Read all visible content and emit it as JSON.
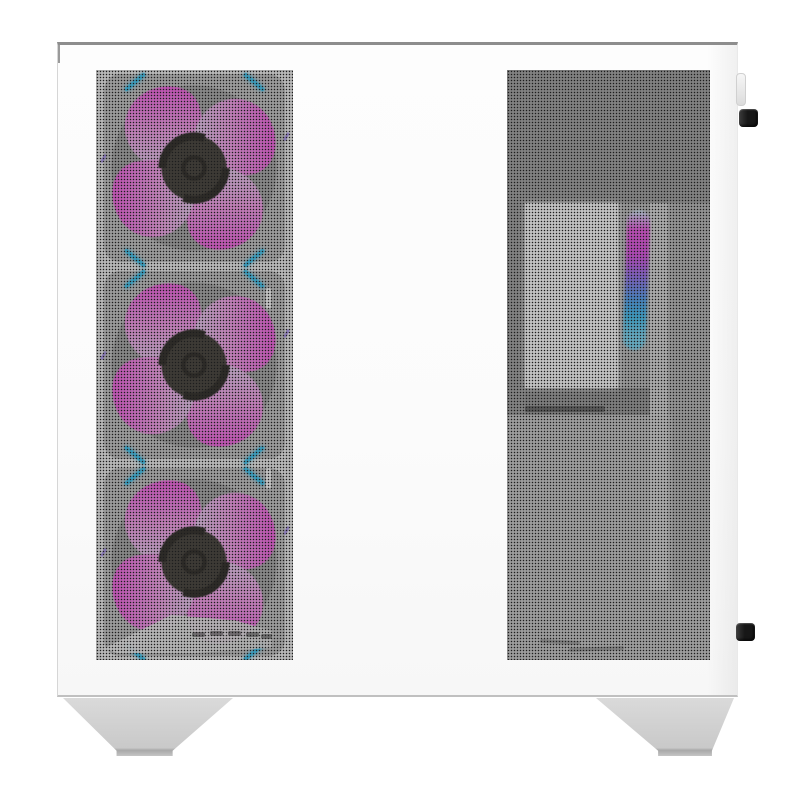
{
  "scene": {
    "subject": "White mid-tower PC case, side view product photo",
    "details": "Front mesh strip with three ARGB fans glowing magenta-to-cyan, perforated side panel showing white interior plate and vertical RGB glow, two black rear thumbscrews, two grey trapezoid feet",
    "background_color": "#ffffff"
  },
  "colors": {
    "bg": "#ffffff",
    "case-body": "#fbfbfb",
    "case-top-edge": "#8d8d8d",
    "case-side-edge": "#d6d6d6",
    "case-bottom-edge": "#c0c0c0",
    "mesh-dot": "#1d1d1d",
    "front-backing": "#efefef",
    "blade-magenta": "#f75de4",
    "blade-pink": "#f8a5ee",
    "blade-lavender": "#e9d2f2",
    "blade-pale-blue": "#a5e0f8",
    "blade-cyan": "#55cff6",
    "fan-hub": "#4a463f",
    "fan-hub-dark": "#34312c",
    "corner-light-cyan": "#49c9f3",
    "accent-purple": "#a78df1",
    "interior-shadow": "#a6a6a6",
    "interior-base": "#c2c2c2",
    "interior-lower": "#cbcbcb",
    "white-plate": "#fdfdfd",
    "light-band": "#dcdcdc",
    "shelf-edge": "#707070",
    "rgb-magenta": "#ee5fe5",
    "rgb-purple": "#9b79f1",
    "rgb-blue": "#58a5f2",
    "rgb-cyan": "#7fd9f7",
    "thumbscrew": "#171717",
    "rear-tab": "#dcdcdc",
    "foot": "#c9c9c9",
    "foot-shadow": "#a8a8a8"
  },
  "front_panel": {
    "fan_count": 3,
    "fan_positions": [
      "top",
      "middle",
      "bottom"
    ],
    "corner_lights_per_fan": 4,
    "mount_notch_count": 2,
    "vent_slit_count": 5
  },
  "side_panel": {
    "visible_components": [
      "white-interior-plate",
      "rgb-light-strip",
      "light-band",
      "shelf-edge",
      "cable-marks"
    ]
  },
  "hardware": {
    "thumbscrew_count": 2,
    "foot_count": 2,
    "rear_tab_count": 1
  }
}
